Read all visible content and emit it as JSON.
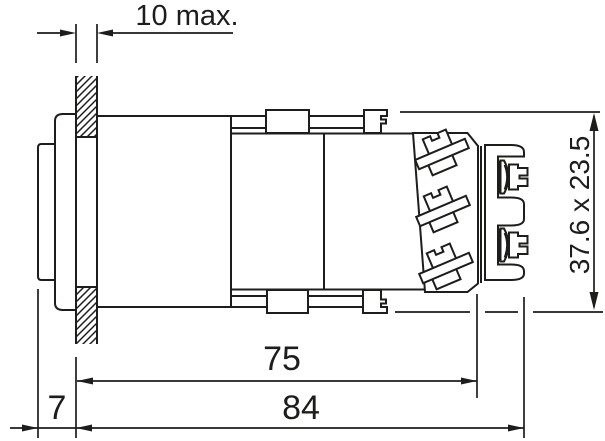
{
  "colors": {
    "background": "#ffffff",
    "line": "#1d1d1b"
  },
  "labels": {
    "panel_thickness": "10 max.",
    "front_protrusion": "7",
    "mounting_depth": "75",
    "overall_length": "84",
    "bezel_face_size": "37.6 x 23.5"
  }
}
